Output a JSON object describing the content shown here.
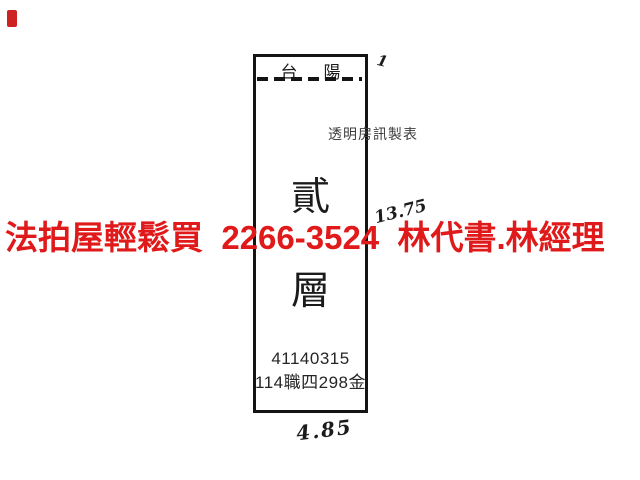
{
  "colors": {
    "background": "#ffffff",
    "ink": "#1b1b1b",
    "watermark_red": "#e01a1a",
    "corner_mark_red": "#cc2222"
  },
  "watermark": {
    "text": "法拍屋輕鬆買  2266-3524  林代書.林經理"
  },
  "sketch": {
    "balcony_label_left": "台",
    "balcony_label_right": "陽",
    "publisher": "透明房訊製表",
    "floor_char_top": "貳",
    "floor_char_bottom": "層",
    "serial": "41140315",
    "case_ref": "114職四298金",
    "dim_height": "13.75",
    "dim_width": "4.85",
    "corner_tick": "1"
  }
}
